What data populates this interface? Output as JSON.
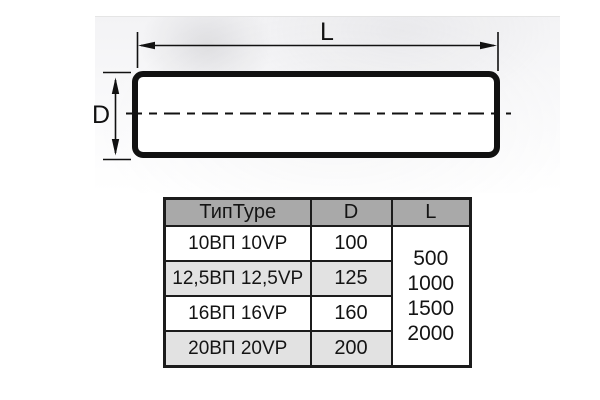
{
  "diagram": {
    "length_label": "L",
    "diameter_label": "D"
  },
  "table": {
    "headers": [
      "ТипType",
      "D",
      "L"
    ],
    "rows": [
      {
        "type": "10ВП 10VP",
        "d": "100"
      },
      {
        "type": "12,5ВП 12,5VP",
        "d": "125"
      },
      {
        "type": "16ВП 16VP",
        "d": "160"
      },
      {
        "type": "20ВП 20VP",
        "d": "200"
      }
    ],
    "l_values": [
      "500",
      "1000",
      "1500",
      "2000"
    ]
  },
  "colors": {
    "header_bg": "#a9a9a9",
    "row_alt_bg": "#e2e2e2",
    "border": "#1c1c1c",
    "ink": "#141414"
  }
}
